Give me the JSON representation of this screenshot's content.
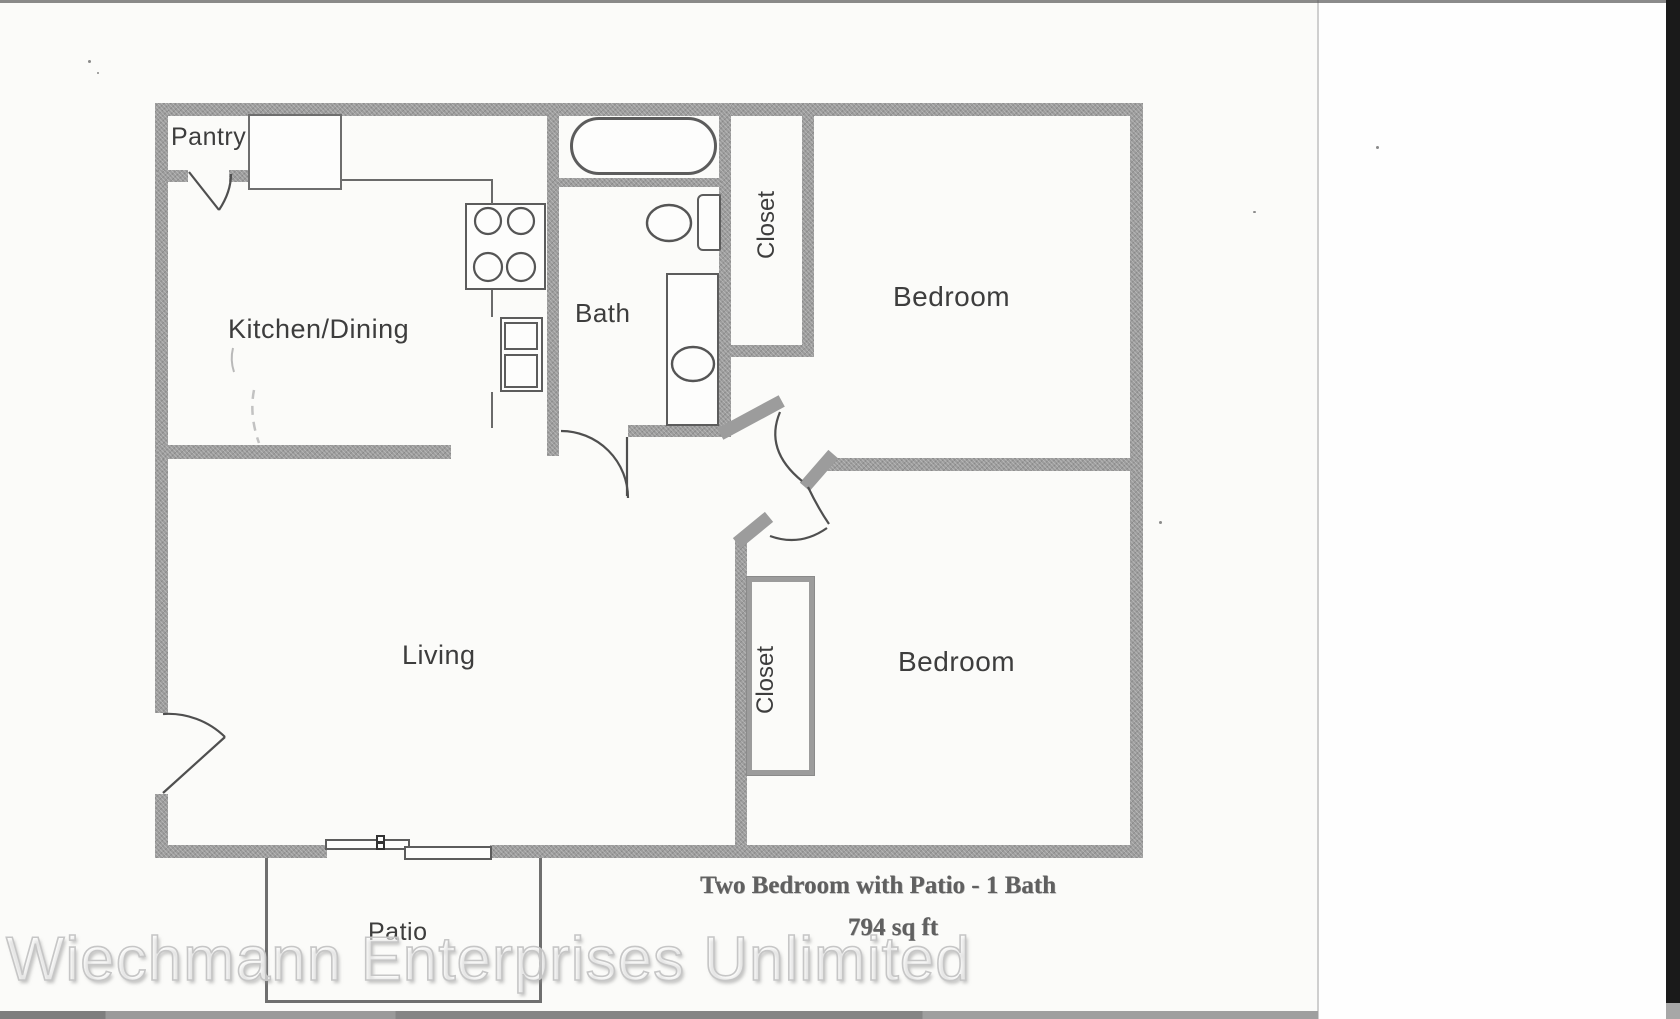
{
  "plan": {
    "rooms": [
      {
        "id": "pantry",
        "label": "Pantry"
      },
      {
        "id": "kitchen_dining",
        "label": "Kitchen/Dining"
      },
      {
        "id": "bath",
        "label": "Bath"
      },
      {
        "id": "closet_top",
        "label": "Closet"
      },
      {
        "id": "bedroom_top",
        "label": "Bedroom"
      },
      {
        "id": "living",
        "label": "Living"
      },
      {
        "id": "closet_bottom",
        "label": "Closet"
      },
      {
        "id": "bedroom_bottom",
        "label": "Bedroom"
      },
      {
        "id": "patio",
        "label": "Patio"
      }
    ],
    "caption": {
      "title": "Two Bedroom with Patio - 1 Bath",
      "area": "794 sq ft"
    },
    "watermark": "Wiechmann Enterprises Unlimited",
    "fixtures": [
      "bathtub",
      "toilet",
      "vanity-sink",
      "stove-cooktop",
      "kitchen-double-sink",
      "pantry-cabinet",
      "closet-box",
      "sliding-patio-door",
      "front-door",
      "pantry-door",
      "bath-door",
      "bedroom-doors",
      "patio-outline"
    ],
    "colors": {
      "wall": "#9c9c9c",
      "fixture_line": "#555555",
      "label_text": "#3d3d3d",
      "caption_text": "#606060",
      "watermark_outline": "#c6c6c6",
      "scanner_edge": "#1a1a1a"
    }
  }
}
